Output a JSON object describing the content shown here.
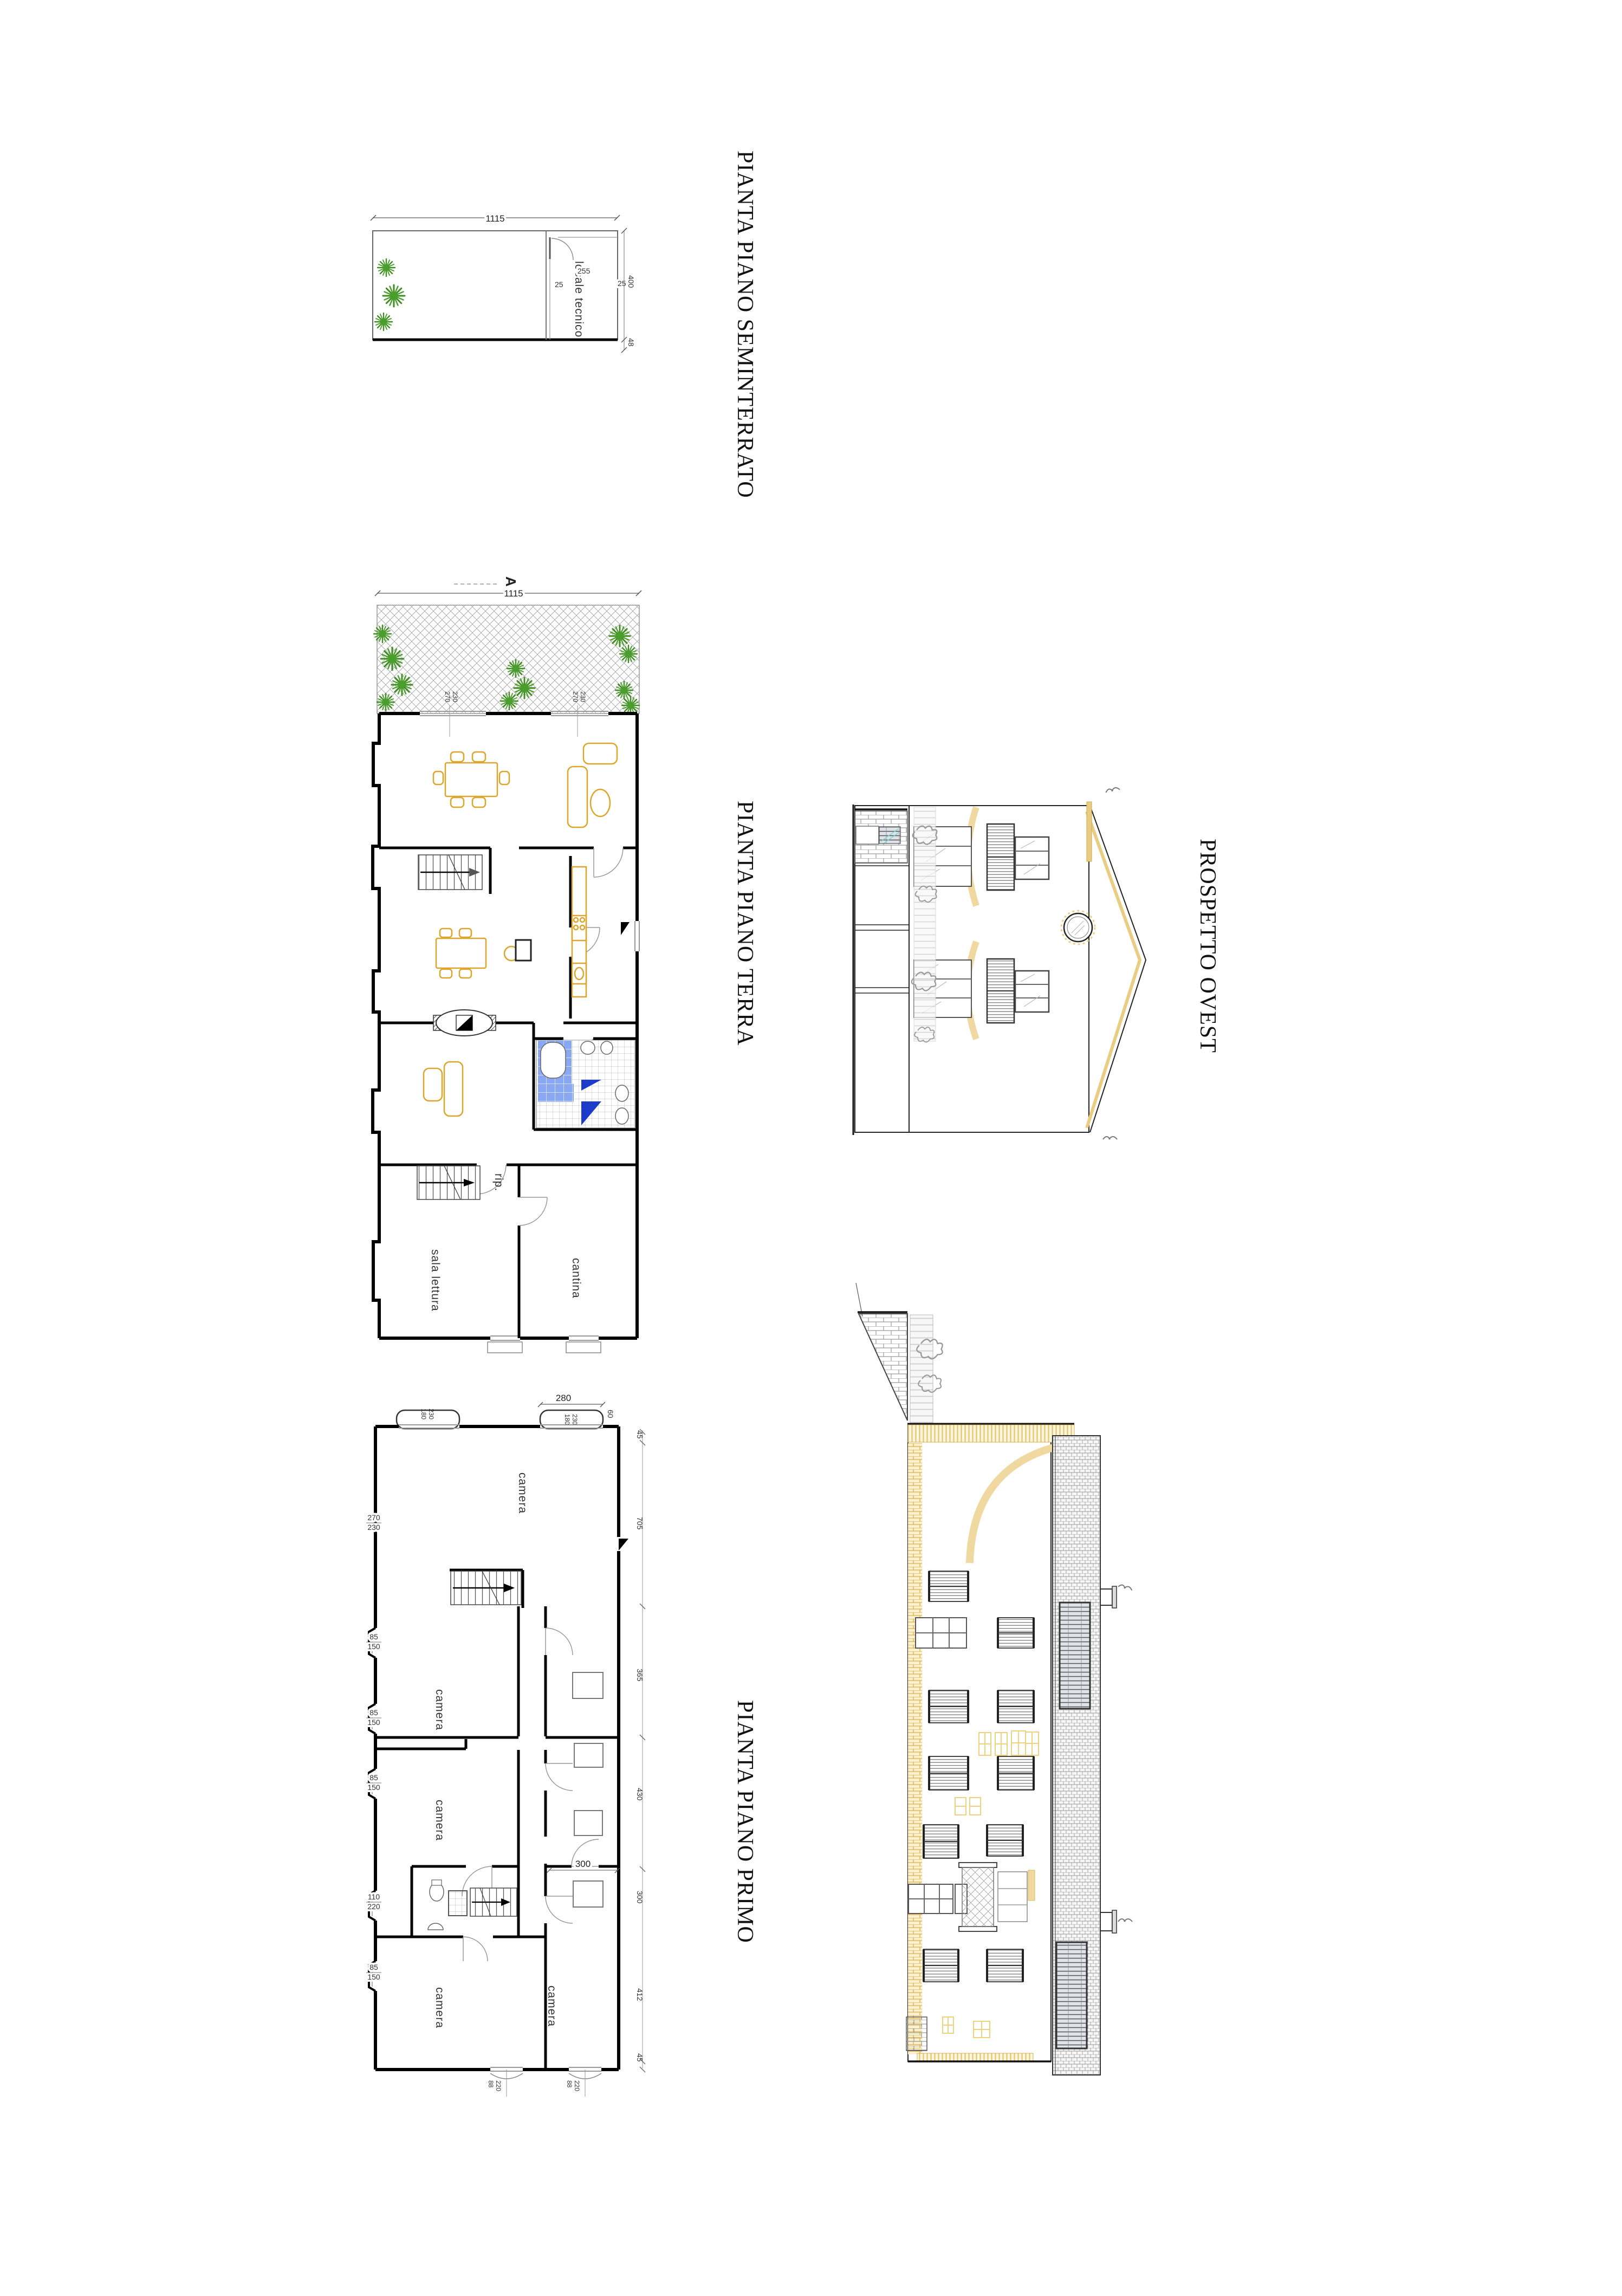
{
  "sheet": {
    "background": "#ffffff"
  },
  "colors": {
    "wall_black": "#000000",
    "thin_gray": "#777777",
    "hatch_gray": "#aaaaaa",
    "furniture_yellow": "#dca62c",
    "plant_green": "#4aa02c",
    "eave_yellow": "#e8cd82",
    "brick_yellow": "#dcae48",
    "bath_tile_blue": "#8aa7f2",
    "bath_tile_blue_dark": "#1d3bcb"
  },
  "titles": {
    "plan_seminterrato": "PIANTA PIANO SEMINTERRATO",
    "plan_terra": "PIANTA PIANO TERRA",
    "plan_primo": "PIANTA PIANO PRIMO",
    "elevation_ovest": "PROSPETTO OVEST"
  },
  "plans": {
    "seminterrato": {
      "room_locale_tecnico": "locale tecnico",
      "dims": {
        "total_width": "1115",
        "wall_left": "25",
        "room_width": "255",
        "wall_right": "25",
        "depth": "400",
        "offset": "48"
      }
    },
    "terra": {
      "section_marker": "A",
      "rooms": {
        "sala_lettura": "sala lettura",
        "cantina": "cantina",
        "ripostiglio": "rip."
      },
      "dims": {
        "total_width": "1115",
        "window_width": "270",
        "window_height": "230"
      }
    },
    "primo": {
      "room_camera": "camera",
      "dims": {
        "d280": "280",
        "d180": "180",
        "d230": "230",
        "d270": "270",
        "d60": "60",
        "d45": "45",
        "d705": "705",
        "d85": "85",
        "d150": "150",
        "d110": "110",
        "d220": "220",
        "d365": "365",
        "d430": "430",
        "d300": "300",
        "d412": "412",
        "d88": "88"
      }
    }
  }
}
